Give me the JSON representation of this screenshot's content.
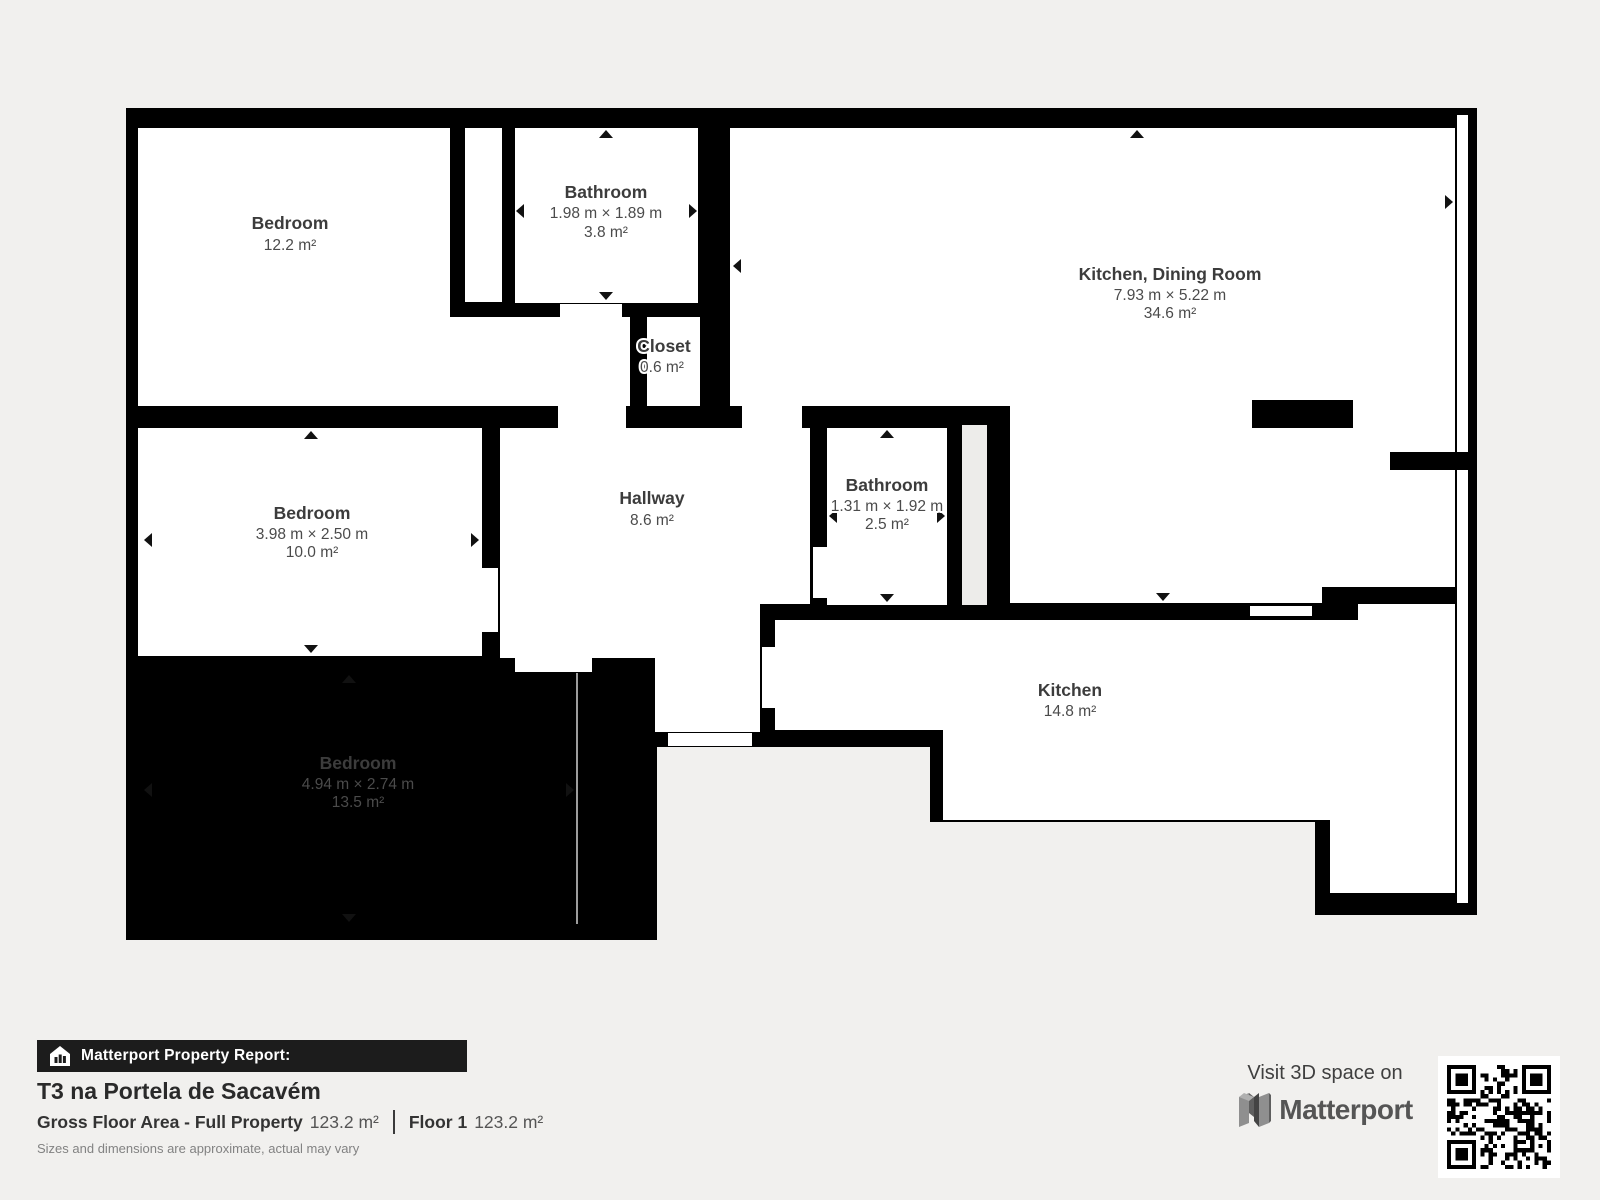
{
  "plan": {
    "rooms": [
      {
        "id": "bedroom-1",
        "name": "Bedroom",
        "dims": "",
        "area": "12.2 m²"
      },
      {
        "id": "bathroom-1",
        "name": "Bathroom",
        "dims": "1.98 m × 1.89 m",
        "area": "3.8 m²"
      },
      {
        "id": "closet",
        "name": "Closet",
        "dims": "",
        "area": "0.6 m²"
      },
      {
        "id": "kitchen-dining",
        "name": "Kitchen, Dining Room",
        "dims": "7.93 m × 5.22 m",
        "area": "34.6 m²"
      },
      {
        "id": "bedroom-2",
        "name": "Bedroom",
        "dims": "3.98 m × 2.50 m",
        "area": "10.0 m²"
      },
      {
        "id": "hallway",
        "name": "Hallway",
        "dims": "",
        "area": "8.6 m²"
      },
      {
        "id": "bathroom-2",
        "name": "Bathroom",
        "dims": "1.31 m × 1.92 m",
        "area": "2.5 m²"
      },
      {
        "id": "kitchen",
        "name": "Kitchen",
        "dims": "",
        "area": "14.8 m²"
      },
      {
        "id": "bedroom-3",
        "name": "Bedroom",
        "dims": "4.94 m × 2.74 m",
        "area": "13.5 m²"
      }
    ]
  },
  "report": {
    "bar_label": "Matterport Property Report:",
    "title": "T3 na Portela de Sacavém",
    "gfa_label": "Gross Floor Area - Full Property",
    "gfa_value": "123.2 m²",
    "floor_label": "Floor 1",
    "floor_value": "123.2 m²",
    "disclaimer": "Sizes and dimensions are approximate, actual may vary"
  },
  "branding": {
    "visit_text": "Visit 3D space on",
    "brand_name": "Matterport"
  },
  "colors": {
    "wall": "#000000",
    "room": "#ffffff",
    "background": "#f1f0ee",
    "shaft": "#edecea",
    "bar": "#1c1c1c"
  }
}
